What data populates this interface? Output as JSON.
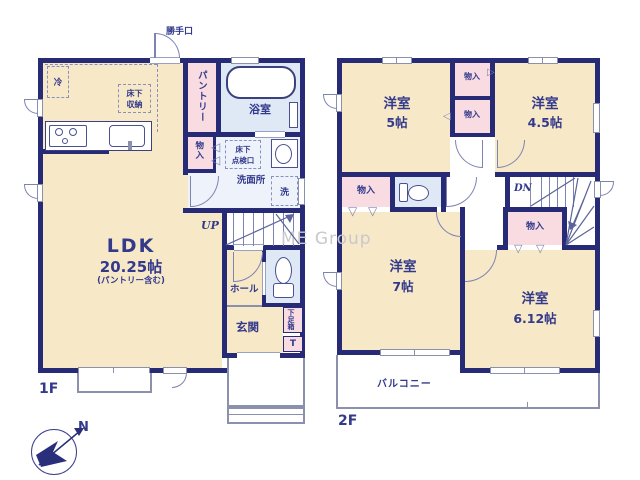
{
  "floor1": {
    "label": "1F",
    "ldk": {
      "name": "LDK",
      "size": "20.25帖",
      "note": "(パントリー含む)"
    },
    "pantry": "パントリー",
    "bathroom": "浴室",
    "washroom": "洗面所",
    "hall": "ホール",
    "entrance": "玄関",
    "back_door": "勝手口",
    "refrigerator": "冷",
    "underfloor_storage_1": "床下",
    "underfloor_storage_2": "収納",
    "underfloor_hatch_1": "床下",
    "underfloor_hatch_2": "点検口",
    "closet": "物入",
    "washer": "洗",
    "shoe_cabinet": "下足箱",
    "shoe_cabinet_t": "T",
    "stairs": "UP"
  },
  "floor2": {
    "label": "2F",
    "rooms": [
      {
        "name": "洋室",
        "size": "5帖"
      },
      {
        "name": "洋室",
        "size": "4.5帖"
      },
      {
        "name": "洋室",
        "size": "7帖"
      },
      {
        "name": "洋室",
        "size": "6.12帖"
      }
    ],
    "closet": "物入",
    "stairs": "DN",
    "balcony": "バルコニー"
  },
  "icons": {
    "tri_left": "◁",
    "tri_right": "▷",
    "tri_down": "▽"
  },
  "watermark": "ME Group",
  "compass_north": "N",
  "colors": {
    "wall": "#272b76",
    "room_cream": "#f7e8c7",
    "closet_pink": "#f8dce1",
    "wet_blue": "#dfe9f6",
    "washroom_blue": "#eef3fb",
    "line_gray": "#8b90ad",
    "text_navy": "#333a8c",
    "watermark_gray": "#c8c8cd"
  }
}
